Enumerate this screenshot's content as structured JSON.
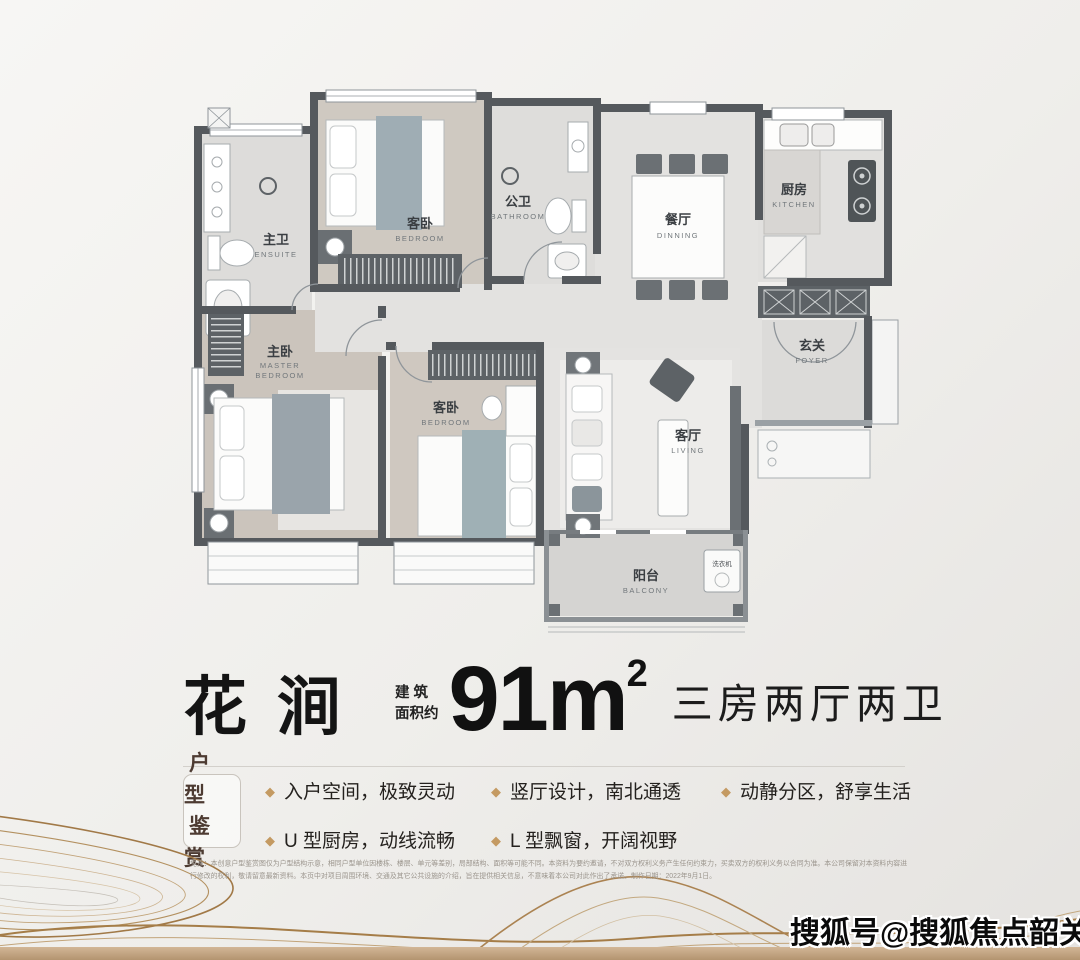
{
  "plan": {
    "rooms": {
      "ensuite": {
        "name": "主卫",
        "en": "ENSUITE"
      },
      "bedroom_top": {
        "name": "客卧",
        "en": "BEDROOM"
      },
      "bathroom": {
        "name": "公卫",
        "en": "BATHROOM"
      },
      "dining": {
        "name": "餐厅",
        "en": "DINNING"
      },
      "kitchen": {
        "name": "厨房",
        "en": "KITCHEN"
      },
      "foyer": {
        "name": "玄关",
        "en": "FOYER"
      },
      "master": {
        "name": "主卧",
        "en1": "MASTER",
        "en2": "BEDROOM"
      },
      "bedroom_second": {
        "name": "客卧",
        "en": "BEDROOM"
      },
      "living": {
        "name": "客厅",
        "en": "LIVING"
      },
      "balcony": {
        "name": "阳台",
        "en": "BALCONY"
      },
      "washer": {
        "name": "洗衣机"
      }
    }
  },
  "title": {
    "name": "花涧",
    "area_label_line1": "建 筑",
    "area_label_line2": "面积约",
    "area_value": "91m",
    "area_exponent": "2",
    "layout_desc": "三房两厅两卫"
  },
  "features": {
    "badge_line1": "户型",
    "badge_line2": "鉴赏",
    "items": [
      "入户空间，极致灵动",
      "竖厅设计，南北通透",
      "动静分区，舒享生活",
      "U 型厨房，动线流畅",
      "L 型飘窗，开阔视野"
    ]
  },
  "disclaimer": "免责：本创意户型鉴赏图仅为户型结构示意，相同户型单位因楼栋、楼层、单元等差别，局部结构、面积等可能不同。本资料为要约邀请，不对双方权利义务产生任何约束力，买卖双方的权利义务以合同为准。本公司保留对本资料内容进行修改的权利，敬请留意最新资料。本页中对项目周围环境、交通及其它公共设施的介绍，旨在提供相关信息，不意味着本公司对此作出了承诺。制作日期：2022年9月1日。",
  "watermark": "搜狐号@搜狐焦点韶关站",
  "colors": {
    "accent_gold": "#c49a62",
    "title_divider": "#cf9a66",
    "wall": "#55595d",
    "bottom_bar": "#c3a888"
  }
}
